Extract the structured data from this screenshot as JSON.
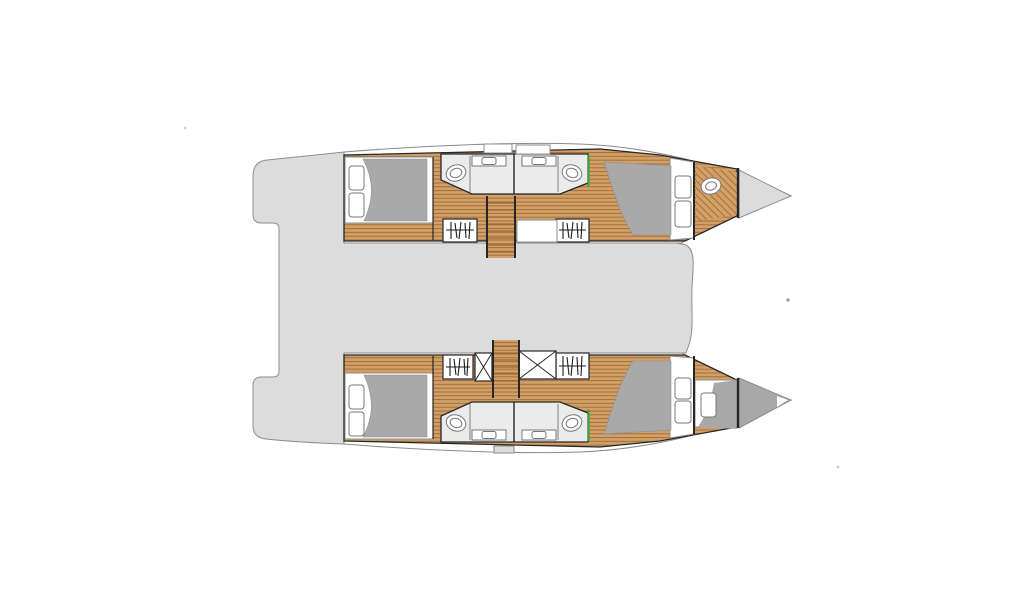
{
  "page": {
    "title": "Catamaran 4-cabin layout floor plan",
    "background": "#ffffff"
  },
  "diagram": {
    "type": "boat-floor-plan",
    "description": "Top view interior layout drawing of a four-cabin sailing catamaran, bows pointing right, two hulls joined by a central deck platform",
    "colors": {
      "white": "#ffffff",
      "deck": "#dcdcdc",
      "outline": "#8c8c8c",
      "line-dark": "#262626",
      "wood": "#d2a066",
      "wood-line": "#8c5c2e",
      "duvet": "#a9a9a9",
      "bath": "#ebebeb",
      "green": "#2fa43c",
      "bow-dark": "#a8a8a8"
    },
    "deck": {
      "label": "central deck platform with aft transom steps"
    },
    "hulls": [
      {
        "id": "upper-hull",
        "label": "upper hull: aft double cabin, two bathrooms with toilets and washbasins, two wardrobes, companionway stairs, forward double cabin, forepeak washbasin, bow locker"
      },
      {
        "id": "lower-hull",
        "label": "lower hull: aft double cabin, two bathrooms with toilets and washbasins, two wardrobes, two shower trays, companionway stairs, forward double cabin, forepeak storage, bow locker"
      }
    ],
    "features": {
      "double_beds": 4,
      "pillows": 4,
      "bed_steps": 4,
      "bathrooms": 4,
      "toilets": 4,
      "sink_counters": 4,
      "wardrobes": 4,
      "staircases": 2,
      "shower_trays": 2,
      "bow_tips": 2
    }
  }
}
